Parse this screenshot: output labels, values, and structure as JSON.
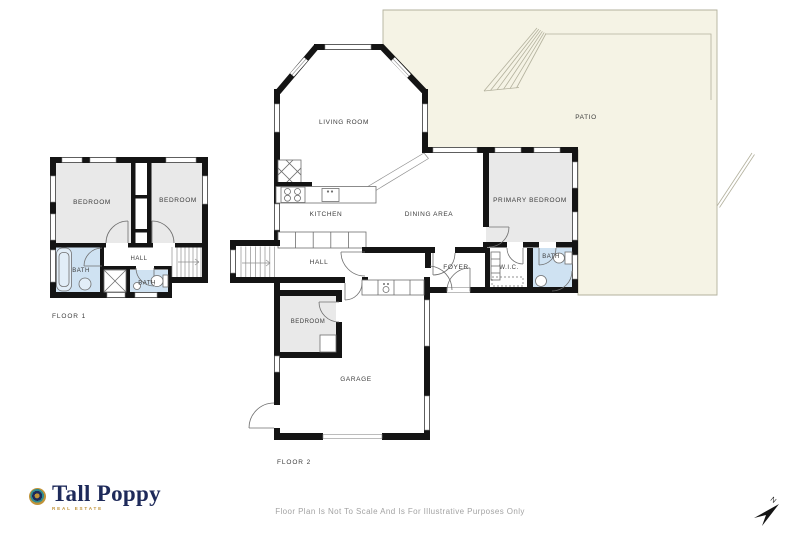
{
  "colors": {
    "wall": "#141414",
    "room": "#e9e9e9",
    "wet": "#cfe2f2",
    "patio": "#f5f3e5",
    "patioline": "#b3b19d",
    "label": "#3c3c3c",
    "disclaimer": "#a3a3a3",
    "navy": "#1e2a5a",
    "gold": "#c09339"
  },
  "floor1": {
    "label": "FLOOR 1",
    "rooms": {
      "bedroom_left": "BEDROOM",
      "bedroom_right": "BEDROOM",
      "bath_main": "BATH",
      "hall": "HALL",
      "bath_small": "BATH"
    }
  },
  "floor2": {
    "label": "FLOOR 2",
    "rooms": {
      "living_room": "LIVING ROOM",
      "patio": "PATIO",
      "kitchen": "KITCHEN",
      "dining_area": "DINING AREA",
      "primary_bedroom": "PRIMARY BEDROOM",
      "hall": "HALL",
      "foyer": "FOYER",
      "wic": "W.I.C.",
      "bath": "BATH",
      "bedroom": "BEDROOM",
      "garage": "GARAGE"
    }
  },
  "branding": {
    "name": "Tall Poppy",
    "tagline": "REAL ESTATE"
  },
  "compass": {
    "north_label": "N"
  },
  "footer": {
    "disclaimer": "Floor Plan Is Not To Scale And Is For Illustrative Purposes Only"
  }
}
